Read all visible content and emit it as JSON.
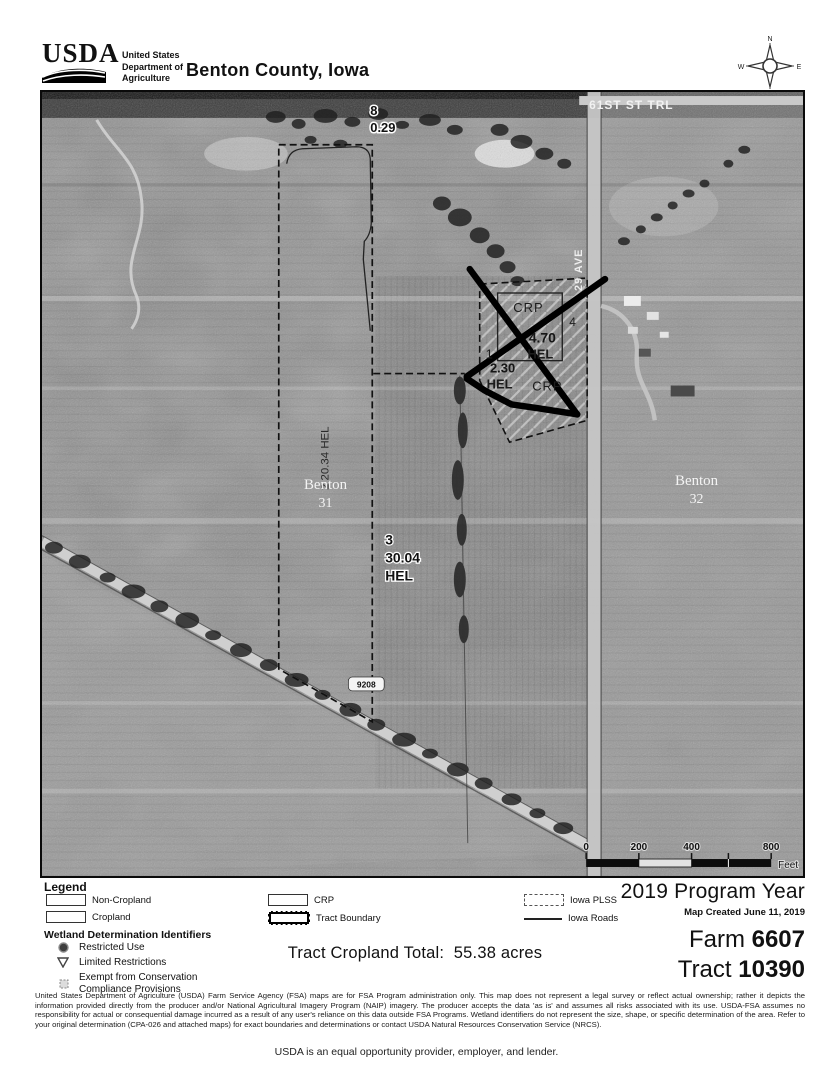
{
  "header": {
    "agency": "USDA",
    "dept_line1": "United States",
    "dept_line2": "Department of",
    "dept_line3": "Agriculture",
    "title": "Benton County, Iowa"
  },
  "compass": {
    "n": "N",
    "e": "E",
    "s": "S",
    "w": "W"
  },
  "map": {
    "street_top": "61ST ST TRL",
    "street_right": "29 AVE",
    "road_shield": "9208",
    "section_left_name": "Benton",
    "section_left_num": "31",
    "section_right_name": "Benton",
    "section_right_num": "32",
    "field8_id": "8",
    "field8_acres": "0.29",
    "field2_label": "2 20.34 HEL",
    "field3_id": "3",
    "field3_acres": "30.04",
    "field3_type": "HEL",
    "crp_top": "CRP",
    "field4_id": "4",
    "field4_acres": "4.70",
    "field4_type": "HEL",
    "field1_id": "1",
    "field1_acres": "2.30",
    "field1_type": "HEL",
    "crp_bottom": "CRP",
    "scale": {
      "t0": "0",
      "t200": "200",
      "t400": "400",
      "t800": "800",
      "unit": "Feet"
    }
  },
  "legend": {
    "title": "Legend",
    "row1": [
      {
        "label": "Non-Cropland"
      },
      {
        "label": "CRP"
      },
      {
        "label": "Iowa PLSS"
      }
    ],
    "row2": [
      {
        "label": "Cropland"
      },
      {
        "label": "Tract Boundary"
      },
      {
        "label": "Iowa Roads"
      }
    ],
    "wetland_title": "Wetland Determination Identifiers",
    "wetland": [
      {
        "label": "Restricted Use"
      },
      {
        "label": "Limited Restrictions"
      },
      {
        "label_line1": "Exempt from Conservation",
        "label_line2": "Compliance Provisions"
      }
    ]
  },
  "info": {
    "program_year": "2019 Program Year",
    "map_created": "Map Created June 11, 2019",
    "farm_label": "Farm",
    "farm_number": "6607",
    "tract_label": "Tract",
    "tract_number": "10390",
    "cropland_total_label": "Tract Cropland Total:",
    "cropland_total_value": "55.38 acres"
  },
  "disclaimer": "United States Department of Agriculture (USDA) Farm Service Agency (FSA) maps are for FSA Program administration only.  This map does not represent a legal survey or reflect actual ownership; rather it depicts the information provided directly from the producer and/or National Agricultural Imagery Program (NAIP) imagery.  The producer accepts the data 'as is' and assumes all risks associated with its use.  USDA-FSA assumes no responsibility for actual or consequential damage incurred as a result of any user's reliance on this data outside FSA Programs.  Wetland identifiers do not represent the size, shape, or specific determination of the area.  Refer to your original determination (CPA-026 and attached maps) for exact boundaries and determinations or contact USDA Natural Resources Conservation Service (NRCS).",
  "footer": "USDA is an equal opportunity provider, employer, and lender."
}
